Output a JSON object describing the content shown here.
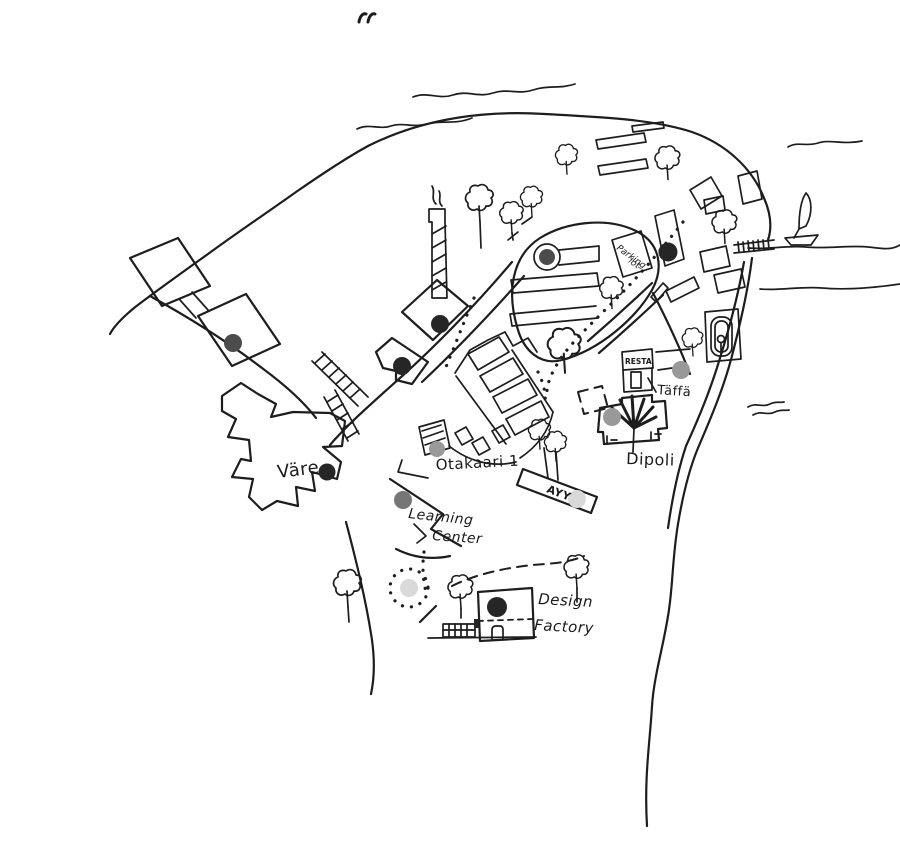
{
  "canvas": {
    "width": 900,
    "height": 842,
    "paper": "#ffffff",
    "ink": "#1d1d1d"
  },
  "marker_colors": {
    "black": "#262626",
    "dark_gray": "#4c4c4c",
    "gray": "#767676",
    "mid_gray": "#999999",
    "pale_gray": "#d9d9d9"
  },
  "labels": {
    "vare": "Väre",
    "otakaari1": "Otakaari 1",
    "learning_line1": "Learning",
    "learning_line2": "Center",
    "ayy": "AYY",
    "dipoli": "Dipoli",
    "taffa": "Täffä",
    "resta": "RESTA",
    "parking_line1": "Parking",
    "parking_line2": "lot",
    "design_line1": "Design",
    "design_line2": "Factory"
  }
}
